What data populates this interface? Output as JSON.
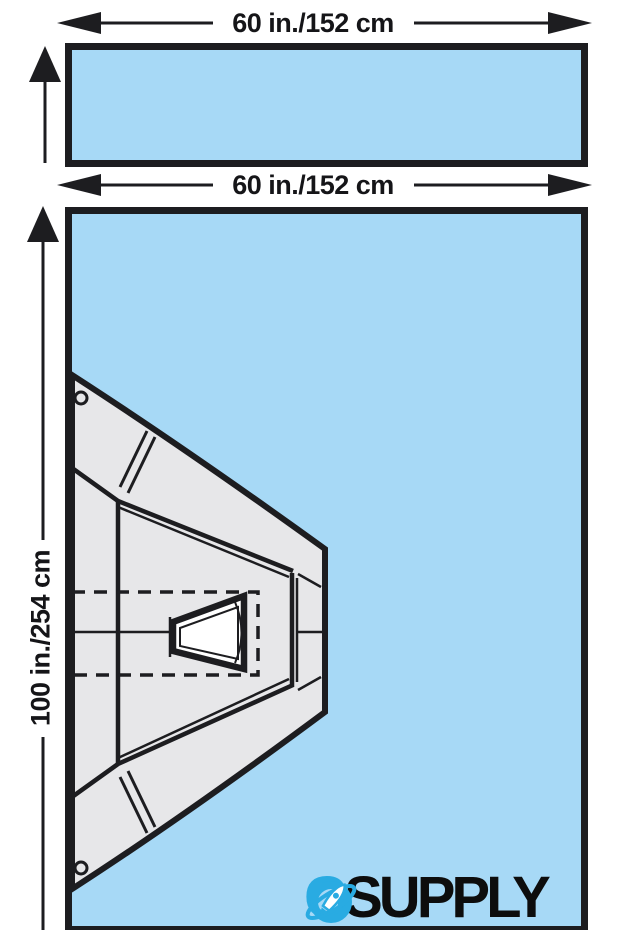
{
  "diagram": {
    "title_hint": "surgical drape two-piece dimension diagram",
    "top_drape": {
      "width_label": "60 in./152 cm"
    },
    "main_drape": {
      "width_label": "60 in./152 cm",
      "height_label": "100 in./254 cm"
    }
  },
  "logo": {
    "g": "G",
    "supply": "SUPPLY",
    "o_icon_name": "rocket-orbit-o-icon"
  },
  "colors": {
    "drape_blue": "#a7d9f6",
    "drape_gray": "#e7e7e9",
    "line_black": "#1d1d20",
    "logo_blue": "#29abe2",
    "logo_black": "#0d0d0d"
  }
}
